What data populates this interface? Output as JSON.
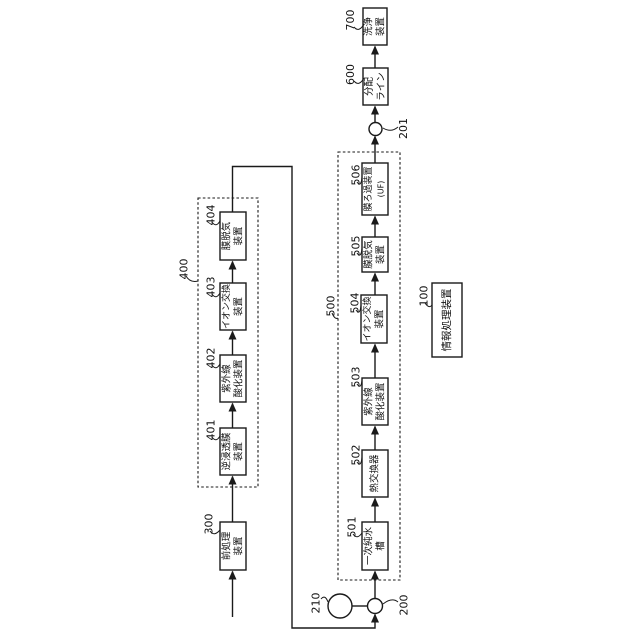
{
  "figure": {
    "background": "#ffffff",
    "line_color": "#1a1a1a",
    "groups": {
      "g400": {
        "ref": "400"
      },
      "g500": {
        "ref": "500"
      }
    },
    "nodes": {
      "n100": {
        "ref": "100",
        "label": "情報処理装置",
        "lines": [
          "情報処理装置"
        ]
      },
      "n300": {
        "ref": "300",
        "label": "前処理装置",
        "lines": [
          "前処理",
          "装置"
        ]
      },
      "n401": {
        "ref": "401",
        "label": "逆浸透膜装置",
        "lines": [
          "逆浸透膜",
          "装置"
        ]
      },
      "n402": {
        "ref": "402",
        "label": "紫外線酸化装置",
        "lines": [
          "紫外線",
          "酸化装置"
        ]
      },
      "n403": {
        "ref": "403",
        "label": "イオン交換装置",
        "lines": [
          "イオン交換",
          "装置"
        ]
      },
      "n404": {
        "ref": "404",
        "label": "膜脱気装置",
        "lines": [
          "膜脱気",
          "装置"
        ]
      },
      "n501": {
        "ref": "501",
        "label": "一次純水槽",
        "lines": [
          "一次純水",
          "槽"
        ]
      },
      "n502": {
        "ref": "502",
        "label": "熱交換器",
        "lines": [
          "熱交換器"
        ]
      },
      "n503": {
        "ref": "503",
        "label": "紫外線酸化装置",
        "lines": [
          "紫外線",
          "酸化装置"
        ]
      },
      "n504": {
        "ref": "504",
        "label": "イオン交換装置",
        "lines": [
          "イオン交換",
          "装置"
        ]
      },
      "n505": {
        "ref": "505",
        "label": "膜脱気装置",
        "lines": [
          "膜脱気",
          "装置"
        ]
      },
      "n506": {
        "ref": "506",
        "label": "膜ろ過装置(UF)",
        "lines": [
          "膜ろ過装置",
          "(UF)"
        ]
      },
      "n600": {
        "ref": "600",
        "label": "分配ライン",
        "lines": [
          "分配",
          "ライン"
        ]
      },
      "n700": {
        "ref": "700",
        "label": "洗浄装置",
        "lines": [
          "洗浄",
          "装置"
        ]
      }
    },
    "symbols": {
      "c200": {
        "ref": "200"
      },
      "c201": {
        "ref": "201"
      },
      "c210": {
        "ref": "210"
      }
    }
  }
}
